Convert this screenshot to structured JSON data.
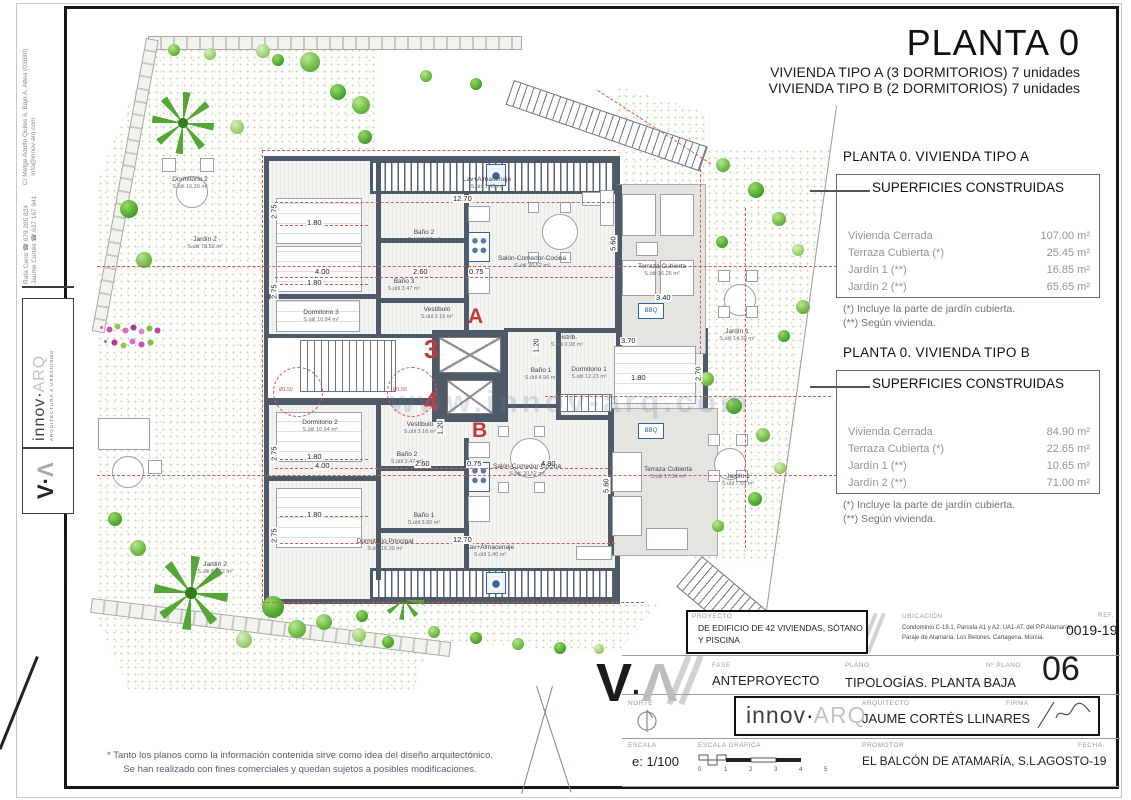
{
  "title": {
    "main": "PLANTA 0",
    "sub1": "VIVIENDA TIPO A (3 DORMITORIOS) 7 unidades",
    "sub2": "VIVIENDA TIPO B (2 DORMITORIOS) 7 unidades"
  },
  "panelA": {
    "heading": "PLANTA 0. VIVIENDA TIPO A",
    "box_title": "SUPERFICIES CONSTRUIDAS",
    "rows": [
      {
        "label": "Vivienda Cerrada",
        "value": "107.00 m²"
      },
      {
        "label": "Terraza Cubierta  (*)",
        "value": "25.45 m²"
      },
      {
        "label": "Jardín 1 (**)",
        "value": "16.85 m²"
      },
      {
        "label": "Jardín 2 (**)",
        "value": "65.65 m²"
      }
    ],
    "foot1": "(*)  Incluye la parte de jardín cubierta.",
    "foot2": "(**) Según vivienda."
  },
  "panelB": {
    "heading": "PLANTA 0. VIVIENDA TIPO B",
    "box_title": "SUPERFICIES CONSTRUIDAS",
    "rows": [
      {
        "label": "Vivienda Cerrada",
        "value": "84.90 m²"
      },
      {
        "label": "Terraza Cubierta (*)",
        "value": "22.65 m²"
      },
      {
        "label": "Jardín 1 (**)",
        "value": "10.65 m²"
      },
      {
        "label": "Jardín 2 (**)",
        "value": "71.00 m²"
      }
    ],
    "foot1": "(*) Incluye la parte de jardín cubierta.",
    "foot2": "(**) Según vivienda."
  },
  "plan": {
    "rooms": [
      {
        "name": "Dormitorio 2",
        "area": "S.útil 16.30 m²"
      },
      {
        "name": "Lav+Almacenaje",
        "area": "S.útil 1.40 m²"
      },
      {
        "name": "Baño 2",
        "area": "S.útil 3.90 m²"
      },
      {
        "name": "Salón-Comedor-Cocina",
        "area": "S.útil 30.52 m²"
      },
      {
        "name": "Baño 3",
        "area": "S.útil 3.47 m²"
      },
      {
        "name": "Dormitorio 3",
        "area": "S.útil 10.94 m²"
      },
      {
        "name": "Vestíbulo",
        "area": "S.útil 3.16 m²"
      },
      {
        "name": "Terraza Cubierta",
        "area": "S.útil 16.26 m²"
      },
      {
        "name": "Jardín 2",
        "area": "S.útil 78.52 m²"
      },
      {
        "name": "Jardín 1",
        "area": "S.útil 14.39 m²"
      },
      {
        "name": "Distrib.",
        "area": "S.útil 0.98 m²"
      },
      {
        "name": "Baño 1",
        "area": "S.útil 4.96 m²"
      },
      {
        "name": "Dormitorio 1",
        "area": "S.útil 12.23 m²"
      },
      {
        "name": "Dormitorio 2",
        "area": "S.útil 10.94 m²"
      },
      {
        "name": "Vestíbulo",
        "area": "S.útil 3.16 m²"
      },
      {
        "name": "Baño 2",
        "area": "S.útil 3.47 m²"
      },
      {
        "name": "Baño 1",
        "area": "S.útil 3.90 m²"
      },
      {
        "name": "Salón-Comedor-Cocina",
        "area": "S.útil 30.52 m²"
      },
      {
        "name": "Dormitorio Principal",
        "area": "S.útil 16.30 m²"
      },
      {
        "name": "Lav+Almacenaje",
        "area": "S.útil 1.40 m²"
      },
      {
        "name": "Terraza Cubierta",
        "area": "S.útil 17.34 m²"
      },
      {
        "name": "Jardín 1",
        "area": "S.útil 7.65 m²"
      },
      {
        "name": "Jardín 2",
        "area": "S.útil 64.22 m²"
      }
    ],
    "marks": {
      "unit_a": "A",
      "unit_b": "B",
      "num3": "3",
      "num4": "4",
      "bbq": "BBQ",
      "diameter": "Ø1.50"
    },
    "dims": {
      "d275": "2.75",
      "d180": "1.80",
      "d400": "4.00",
      "d260": "2.60",
      "d1270": "12.70",
      "d075": "0.75",
      "d560": "5.60",
      "d340": "3.40",
      "d370": "3.70",
      "d270": "2.70",
      "d480": "4.80",
      "d120": "1.20"
    }
  },
  "watermark": "www.innov-arq.com",
  "brand": {
    "innov": "innov",
    "dot": "·",
    "arq": "ARQ",
    "tagline": "ARQUITECTURA e URBANISMO",
    "mark_v": "V",
    "mark_dot": "·",
    "mark_a": "Λ"
  },
  "sidebar": {
    "contact1": "Rafa Cano ☎ 679 285 824",
    "contact2": "Jaume Cortés ☎ 637 167 941",
    "address": "C/ Metge Adolfo Quiles 6, Bajo A, Altea (03690)",
    "email": "info@innov-arq.com"
  },
  "titleblock": {
    "proyecto_label": "PROYECTO",
    "proyecto_line1": "DE EDIFICIO DE 42 VIVIENDAS, SÓTANO",
    "proyecto_line2": "Y PISCINA",
    "ubicacion_label": "UBICACIÓN",
    "ubicacion_line1": "Condominio C-19.1, Parcela A1 y A2. UA1-AT. del P.P.Atamaría.",
    "ubicacion_line2": "Paraje de Atamaría. Los Belones. Cartagena. Múrcia.",
    "ref_label": "REF.",
    "ref": "0019-19",
    "fase_label": "FASE",
    "fase": "ANTEPROYECTO",
    "plano_label": "PLANO",
    "plano": "TIPOLOGÍAS. PLANTA BAJA",
    "nplano_label": "Nº PLANO",
    "nplano": "06",
    "norte_label": "NORTE",
    "arquitecto_label": "ARQUITECTO",
    "arquitecto": "JAUME CORTÉS LLINARES",
    "firma_label": "FIRMA",
    "escala_label": "ESCALA",
    "escala": "e: 1/100",
    "escala_grafica_label": "ESCALA GRÁFICA",
    "scale_ticks": [
      "0",
      "1",
      "2",
      "3",
      "4",
      "5"
    ],
    "promotor_label": "PROMOTOR",
    "promotor": "EL BALCÓN DE ATAMARÍA, S.L.",
    "fecha_label": "FECHA",
    "fecha": "AGOSTO-19"
  },
  "disclaimer": {
    "line1": "* Tanto los planos como la información contenida sirve como idea del diseño arquitectónico.",
    "line2": "Se han realizado con fines comerciales y quedan sujetos a posibles modificaciones."
  },
  "colors": {
    "wall": "#4e5a68",
    "dim_red": "#d45b5b",
    "mark_red": "#c23b3b",
    "garden_green": "#55a637",
    "fixture_blue": "#35639f",
    "terrace_gray": "#e4e4e1"
  }
}
